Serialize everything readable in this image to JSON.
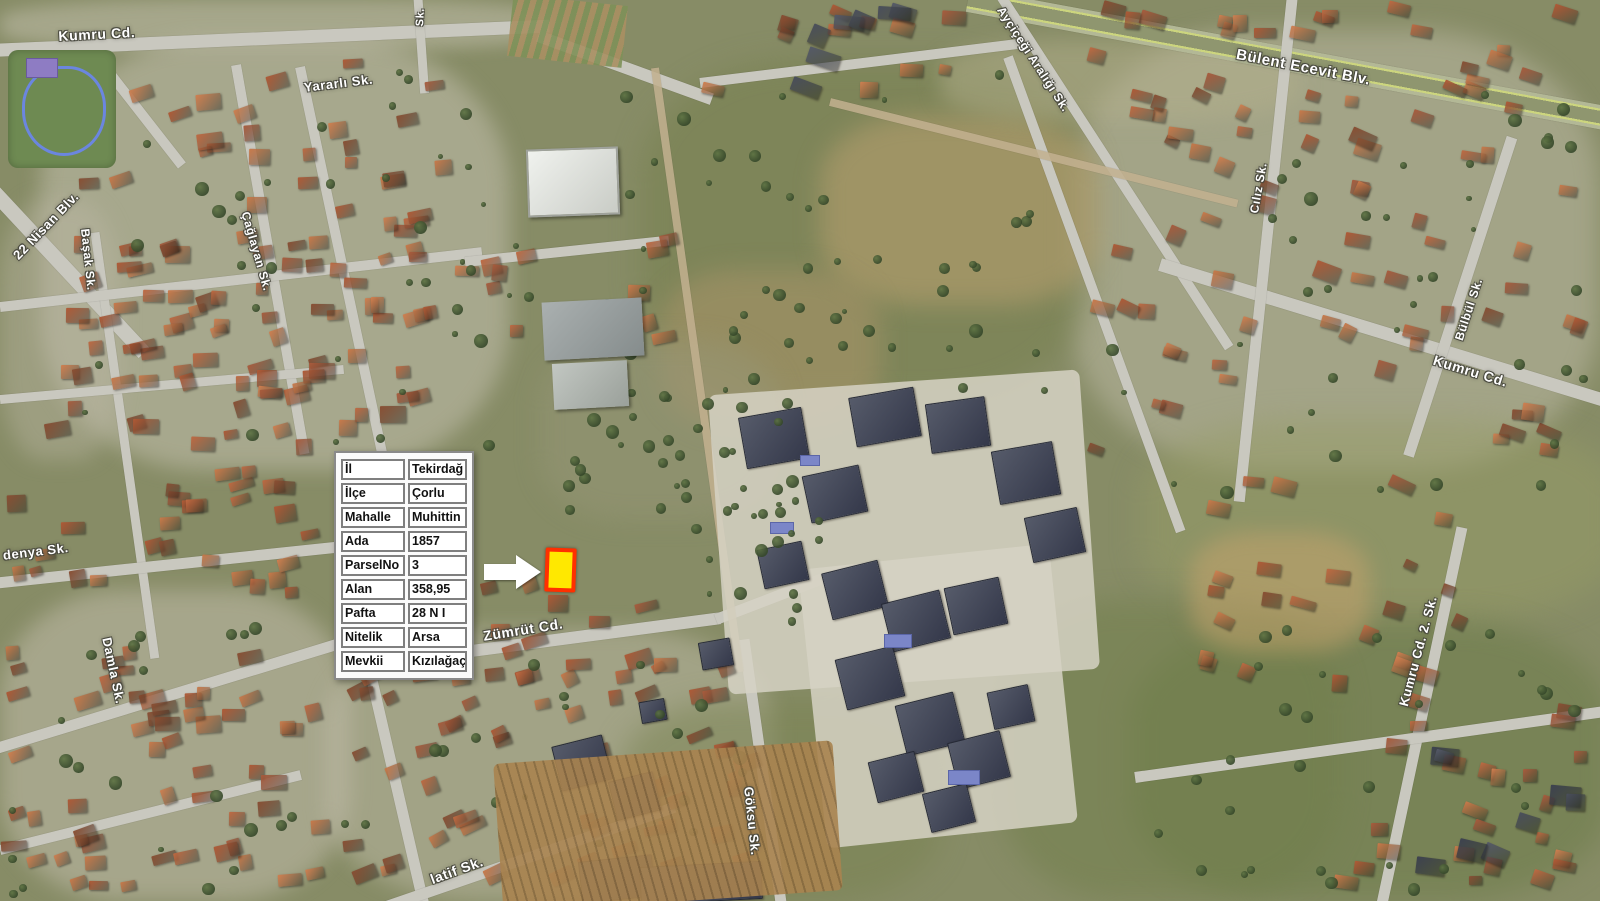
{
  "map": {
    "street_labels": [
      {
        "text": "Kumru Cd.",
        "x": 58,
        "y": 28,
        "rot": -3,
        "size": 14
      },
      {
        "text": "Yararlı Sk.",
        "x": 303,
        "y": 80,
        "rot": -7,
        "size": 13
      },
      {
        "text": "22 Nisan Blv.",
        "x": 10,
        "y": 252,
        "rot": -46,
        "size": 13
      },
      {
        "text": "Başak Sk.",
        "x": 92,
        "y": 228,
        "rot": 84,
        "size": 12
      },
      {
        "text": "Çağlayan Sk.",
        "x": 252,
        "y": 210,
        "rot": 74,
        "size": 12
      },
      {
        "text": "denya Sk.",
        "x": 2,
        "y": 548,
        "rot": -7,
        "size": 13
      },
      {
        "text": "Damla Sk.",
        "x": 114,
        "y": 636,
        "rot": 78,
        "size": 13
      },
      {
        "text": "Zümrüt Cd.",
        "x": 482,
        "y": 628,
        "rot": -9,
        "size": 14
      },
      {
        "text": "Göksu Sk.",
        "x": 756,
        "y": 786,
        "rot": 84,
        "size": 13
      },
      {
        "text": "latif Sk.",
        "x": 428,
        "y": 872,
        "rot": -20,
        "size": 14
      },
      {
        "text": "Ayçiçeği Aralığı Sk.",
        "x": 1006,
        "y": 4,
        "rot": 57,
        "size": 12
      },
      {
        "text": "Bülent Ecevit Blv.",
        "x": 1238,
        "y": 46,
        "rot": 11,
        "size": 15
      },
      {
        "text": "Cılız Sk.",
        "x": 1247,
        "y": 212,
        "rot": -80,
        "size": 12
      },
      {
        "text": "Bülbül Sk.",
        "x": 1452,
        "y": 338,
        "rot": -72,
        "size": 12
      },
      {
        "text": "Kumru Cd.",
        "x": 1436,
        "y": 352,
        "rot": 17,
        "size": 14
      },
      {
        "text": "Kumru Cd. 2. Sk.",
        "x": 1396,
        "y": 704,
        "rot": -75,
        "size": 13
      },
      {
        "text": "Sk.",
        "x": 414,
        "y": 26,
        "rot": -87,
        "size": 11
      }
    ]
  },
  "parcel_info": {
    "rows": [
      {
        "label": "İl",
        "value": "Tekirdağ"
      },
      {
        "label": "İlçe",
        "value": "Çorlu"
      },
      {
        "label": "Mahalle",
        "value": "Muhittin"
      },
      {
        "label": "Ada",
        "value": "1857"
      },
      {
        "label": "ParselNo",
        "value": "3"
      },
      {
        "label": "Alan",
        "value": "358,95"
      },
      {
        "label": "Pafta",
        "value": "28 N I"
      },
      {
        "label": "Nitelik",
        "value": "Arsa"
      },
      {
        "label": "Mevkii",
        "value": "Kızılağaç"
      }
    ]
  },
  "annotations": {
    "parcel_fill": "#ffe800",
    "parcel_border": "#ff3000",
    "arrow_color": "#ffffff"
  }
}
